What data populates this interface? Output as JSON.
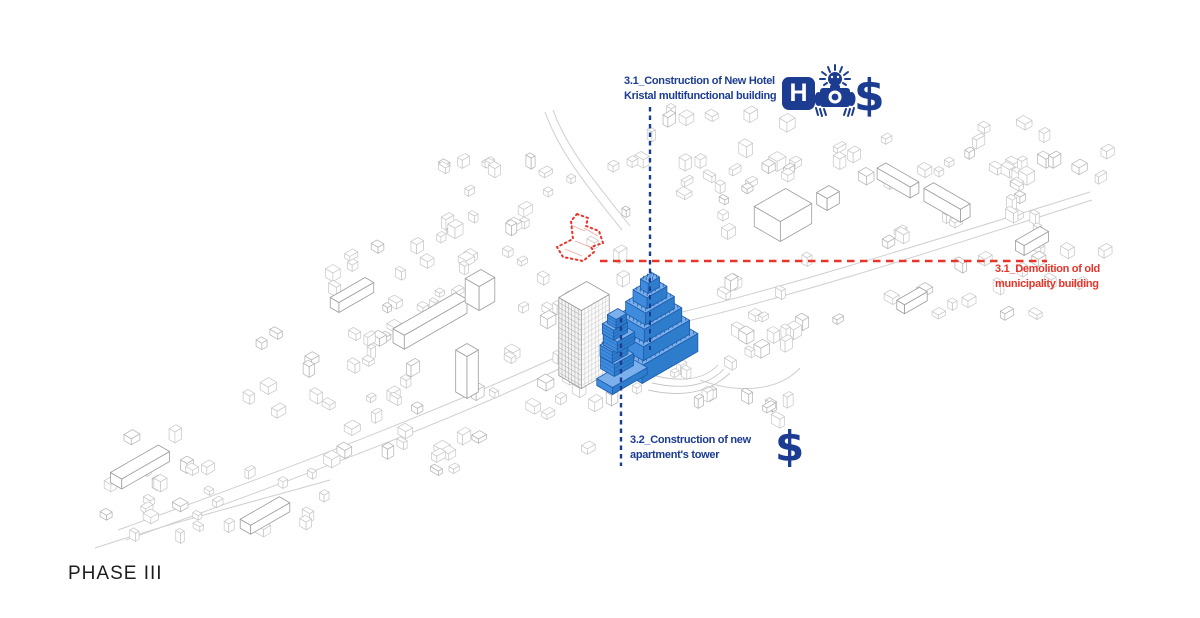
{
  "page": {
    "phase_label": "PHASE III"
  },
  "colors": {
    "navy": "#1c3c92",
    "red": "#e8342a",
    "phase_text": "#1d1d1b",
    "map_line": "#c6c6c6",
    "map_line_dark": "#9e9e9e",
    "blue_face": "#3f8cdf",
    "blue_face_dark": "#2e7ccc",
    "blue_top": "#7bb0ec",
    "blue_edge": "#1d5dab",
    "red_inner": "#f0a9a4"
  },
  "annotations": {
    "hotel": {
      "line1": "3.1_Construction of New Hotel",
      "line2": "Kristal multifunctional building"
    },
    "demolition": {
      "line1": "3.1_Demolition of old",
      "line2": "municipality building"
    },
    "apartments": {
      "line1": "3.2_Construction of new",
      "line2": "apartment's tower"
    }
  },
  "icons": {
    "hotel_letter": "H",
    "dollar_top": "$",
    "dollar_bottom": "$",
    "tourist_camera": "tourist-camera-icon"
  },
  "map": {
    "clusters": [
      {
        "x": 95,
        "y": 435,
        "w": 115,
        "h": 100,
        "n": 10,
        "seed": 11
      },
      {
        "x": 185,
        "y": 468,
        "w": 150,
        "h": 75,
        "n": 13,
        "seed": 22
      },
      {
        "x": 295,
        "y": 372,
        "w": 185,
        "h": 100,
        "n": 22,
        "seed": 33
      },
      {
        "x": 205,
        "y": 330,
        "w": 190,
        "h": 85,
        "n": 13,
        "seed": 44
      },
      {
        "x": 320,
        "y": 245,
        "w": 150,
        "h": 95,
        "n": 16,
        "seed": 55
      },
      {
        "x": 430,
        "y": 165,
        "w": 190,
        "h": 160,
        "n": 38,
        "seed": 66
      },
      {
        "x": 620,
        "y": 112,
        "w": 200,
        "h": 130,
        "n": 30,
        "seed": 77
      },
      {
        "x": 830,
        "y": 125,
        "w": 220,
        "h": 110,
        "n": 24,
        "seed": 88
      },
      {
        "x": 880,
        "y": 235,
        "w": 200,
        "h": 100,
        "n": 18,
        "seed": 99
      },
      {
        "x": 600,
        "y": 332,
        "w": 185,
        "h": 92,
        "n": 26,
        "seed": 111
      },
      {
        "x": 487,
        "y": 352,
        "w": 120,
        "h": 100,
        "n": 14,
        "seed": 122
      },
      {
        "x": 700,
        "y": 262,
        "w": 150,
        "h": 80,
        "n": 12,
        "seed": 133
      },
      {
        "x": 1000,
        "y": 148,
        "w": 105,
        "h": 115,
        "n": 13,
        "seed": 144
      },
      {
        "x": 95,
        "y": 498,
        "w": 210,
        "h": 46,
        "n": 8,
        "seed": 155
      }
    ],
    "roads": [
      "M118,530 C300,465 470,398 598,338",
      "M126,540 C310,474 485,408 606,346",
      "M640,322 C760,295 920,245 1090,192",
      "M644,331 C770,304 925,254 1092,200",
      "M545,112 C558,148 580,178 622,230",
      "M553,110 C566,146 590,176 630,226",
      "M700,380 C740,395 780,390 800,368",
      "M95,548 C180,520 260,500 330,480"
    ],
    "terraces": [
      "M648,390 Q700,402 730,373",
      "M652,383 Q700,394 724,369",
      "M656,376 Q698,386 718,365"
    ],
    "landmarks": [
      {
        "c": [
          140,
          472
        ],
        "a": 13,
        "b": 55,
        "h": 10
      },
      {
        "c": [
          265,
          520
        ],
        "a": 12,
        "b": 45,
        "h": 9
      },
      {
        "c": [
          430,
          328
        ],
        "a": 13,
        "b": 72,
        "h": 14
      },
      {
        "c": [
          480,
          302
        ],
        "a": 16,
        "b": 18,
        "h": 24
      },
      {
        "c": [
          467,
          392
        ],
        "a": 13,
        "b": 13,
        "h": 42
      },
      {
        "c": [
          783,
          225
        ],
        "a": 30,
        "b": 36,
        "h": 20
      },
      {
        "c": [
          828,
          204
        ],
        "a": 12,
        "b": 14,
        "h": 12
      },
      {
        "c": [
          898,
          186
        ],
        "a": 38,
        "b": 10,
        "h": 11
      },
      {
        "c": [
          947,
          209
        ],
        "a": 42,
        "b": 11,
        "h": 13
      },
      {
        "c": [
          1032,
          246
        ],
        "a": 10,
        "b": 28,
        "h": 10
      },
      {
        "c": [
          352,
          300
        ],
        "a": 10,
        "b": 40,
        "h": 10
      },
      {
        "c": [
          912,
          305
        ],
        "a": 9,
        "b": 26,
        "h": 9
      }
    ],
    "existing_tower": {
      "c": [
        584,
        374
      ],
      "a": 26,
      "b": 32,
      "h": 78
    },
    "hotel": {
      "g": [
        650,
        356
      ],
      "layers": [
        [
          46,
          64,
          18
        ],
        [
          38,
          53,
          14
        ],
        [
          30,
          43,
          13
        ],
        [
          23,
          33,
          12
        ],
        [
          16,
          23,
          11
        ],
        [
          9,
          13,
          10
        ]
      ]
    },
    "apartment_tower": {
      "podium": {
        "c": [
          622,
          380
        ],
        "a": 18,
        "b": 40,
        "h": 7
      },
      "g": [
        617,
        373
      ],
      "boxes": [
        [
          16,
          22,
          12
        ],
        [
          14,
          18,
          11
        ],
        [
          16,
          20,
          11
        ],
        [
          13,
          16,
          10
        ],
        [
          10,
          12,
          9
        ]
      ],
      "dx": [
        0,
        -3,
        2,
        -2,
        0
      ]
    },
    "demolition": {
      "outline": [
        [
          577,
          214
        ],
        [
          588,
          218
        ],
        [
          586,
          226
        ],
        [
          599,
          231
        ],
        [
          603,
          243
        ],
        [
          591,
          247
        ],
        [
          594,
          252
        ],
        [
          583,
          261
        ],
        [
          563,
          257
        ],
        [
          557,
          247
        ],
        [
          573,
          239
        ],
        [
          571,
          221
        ]
      ],
      "inner": [
        [
          [
            571,
            225
          ],
          [
            585,
            231
          ]
        ],
        [
          [
            575,
            241
          ],
          [
            590,
            247
          ]
        ],
        [
          [
            565,
            249
          ],
          [
            582,
            256
          ]
        ],
        [
          [
            584,
            228
          ],
          [
            598,
            236
          ]
        ]
      ]
    },
    "leaders": {
      "red_line": {
        "x1": 600,
        "y1": 261,
        "x2": 1047,
        "y2": 261
      },
      "blue_top": {
        "x": 650,
        "y1": 107,
        "y2": 276
      },
      "blue_top_inner": {
        "x": 650,
        "y1": 278,
        "y2": 350
      },
      "blue_bottom": {
        "x": 621,
        "y1": 318,
        "y2": 466
      }
    }
  }
}
